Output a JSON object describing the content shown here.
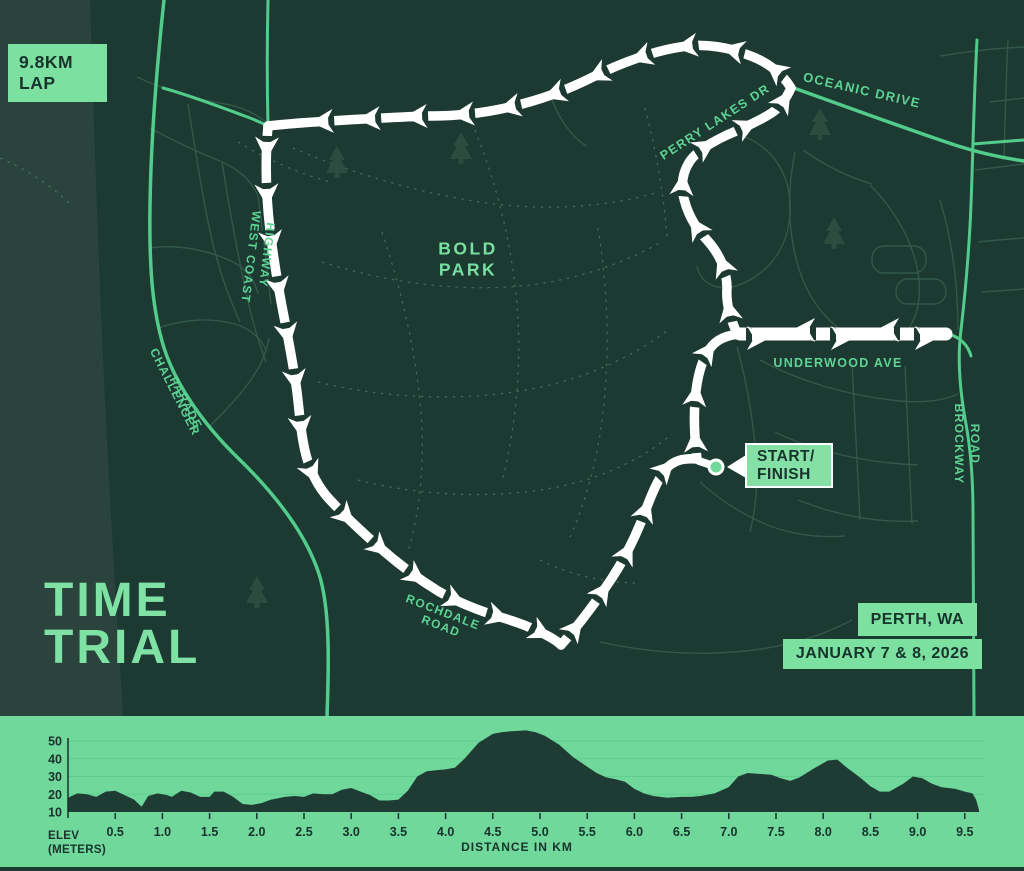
{
  "badge_lap": {
    "line1": "9.8KM",
    "line2": "LAP"
  },
  "title": {
    "line1": "TIME",
    "line2": "TRIAL"
  },
  "event": {
    "location": "PERTH, WA",
    "dates": "JANUARY 7 & 8, 2026"
  },
  "map": {
    "park": {
      "line1": "BOLD",
      "line2": "PARK"
    },
    "start_finish": {
      "line1": "START/",
      "line2": "FINISH"
    },
    "roads": {
      "oceanic": "OCEANIC DRIVE",
      "perry": "PERRY LAKES DR",
      "west_coast": {
        "line1": "WEST COAST",
        "line2": "HIGHWAY"
      },
      "challenger": {
        "line1": "CHALLENGER",
        "line2": "PARADE"
      },
      "underwood": "UNDERWOOD AVE",
      "brockway": {
        "line1": "BROCKWAY",
        "line2": "ROAD"
      },
      "rochdale": {
        "line1": "ROCHDALE",
        "line2": "ROAD"
      }
    }
  },
  "colors": {
    "map_bg": "#1c3932",
    "coast_band": "#2a443d",
    "accent_green": "#7ce0a1",
    "road_green": "#52cc8a",
    "minor_road": "#33584a",
    "trail": "#47735f",
    "route_white": "#ffffff",
    "chart_bg": "#6fd89a",
    "chart_grid": "#5ecd90",
    "chart_fill": "#1e3b34",
    "dark_text": "#17332c"
  },
  "chart_data": {
    "type": "area",
    "xlabel": "DISTANCE IN KM",
    "ylabel_line1": "ELEV",
    "ylabel_line2": "(METERS)",
    "x_ticks": [
      "0.5",
      "1.0",
      "1.5",
      "2.0",
      "2.5",
      "3.0",
      "3.5",
      "4.0",
      "4.5",
      "5.0",
      "5.5",
      "6.0",
      "6.5",
      "7.0",
      "7.5",
      "8.0",
      "8.5",
      "9.0",
      "9.5"
    ],
    "y_ticks": [
      10,
      20,
      30,
      40,
      50
    ],
    "xlim": [
      0,
      9.9
    ],
    "ylim": [
      10,
      57
    ],
    "grid": true,
    "series": [
      {
        "name": "elevation_m",
        "points": [
          [
            0,
            18
          ],
          [
            0.1,
            20.5
          ],
          [
            0.2,
            20
          ],
          [
            0.3,
            18.5
          ],
          [
            0.4,
            21.5
          ],
          [
            0.5,
            22
          ],
          [
            0.6,
            19.5
          ],
          [
            0.7,
            17
          ],
          [
            0.78,
            13
          ],
          [
            0.85,
            19
          ],
          [
            0.95,
            20.5
          ],
          [
            1.05,
            19.5
          ],
          [
            1.1,
            18.5
          ],
          [
            1.2,
            22
          ],
          [
            1.3,
            21
          ],
          [
            1.4,
            18.5
          ],
          [
            1.5,
            18.5
          ],
          [
            1.55,
            21.5
          ],
          [
            1.65,
            21.5
          ],
          [
            1.75,
            18.5
          ],
          [
            1.85,
            14.5
          ],
          [
            1.95,
            14
          ],
          [
            2.05,
            15
          ],
          [
            2.15,
            17
          ],
          [
            2.3,
            18.5
          ],
          [
            2.4,
            19
          ],
          [
            2.5,
            18.5
          ],
          [
            2.6,
            20.5
          ],
          [
            2.7,
            20
          ],
          [
            2.8,
            20
          ],
          [
            2.9,
            22.5
          ],
          [
            3.0,
            23.5
          ],
          [
            3.1,
            21.5
          ],
          [
            3.2,
            19.5
          ],
          [
            3.3,
            16.5
          ],
          [
            3.4,
            16.5
          ],
          [
            3.5,
            17
          ],
          [
            3.6,
            22
          ],
          [
            3.7,
            30
          ],
          [
            3.8,
            33
          ],
          [
            3.9,
            33.5
          ],
          [
            4.0,
            34
          ],
          [
            4.1,
            35
          ],
          [
            4.2,
            40
          ],
          [
            4.35,
            49
          ],
          [
            4.5,
            54
          ],
          [
            4.6,
            55
          ],
          [
            4.7,
            55.5
          ],
          [
            4.85,
            56
          ],
          [
            4.95,
            55
          ],
          [
            5.05,
            53
          ],
          [
            5.2,
            48
          ],
          [
            5.35,
            41
          ],
          [
            5.5,
            35.5
          ],
          [
            5.6,
            32
          ],
          [
            5.7,
            29.5
          ],
          [
            5.8,
            28.5
          ],
          [
            5.9,
            27
          ],
          [
            6.0,
            23
          ],
          [
            6.1,
            20.5
          ],
          [
            6.2,
            19
          ],
          [
            6.35,
            18
          ],
          [
            6.5,
            18.5
          ],
          [
            6.6,
            18.5
          ],
          [
            6.7,
            19
          ],
          [
            6.85,
            20.5
          ],
          [
            7.0,
            24
          ],
          [
            7.1,
            30
          ],
          [
            7.2,
            32
          ],
          [
            7.3,
            31.5
          ],
          [
            7.45,
            31
          ],
          [
            7.55,
            29
          ],
          [
            7.65,
            27.5
          ],
          [
            7.75,
            29.5
          ],
          [
            7.9,
            34.5
          ],
          [
            8.05,
            39
          ],
          [
            8.15,
            39.5
          ],
          [
            8.25,
            35
          ],
          [
            8.4,
            29
          ],
          [
            8.5,
            24.5
          ],
          [
            8.6,
            21.5
          ],
          [
            8.7,
            21.5
          ],
          [
            8.85,
            26
          ],
          [
            8.95,
            30
          ],
          [
            9.05,
            29
          ],
          [
            9.15,
            26
          ],
          [
            9.25,
            24
          ],
          [
            9.4,
            23
          ],
          [
            9.5,
            21.5
          ],
          [
            9.58,
            20.5
          ],
          [
            9.62,
            17
          ],
          [
            9.65,
            11
          ]
        ]
      }
    ]
  }
}
